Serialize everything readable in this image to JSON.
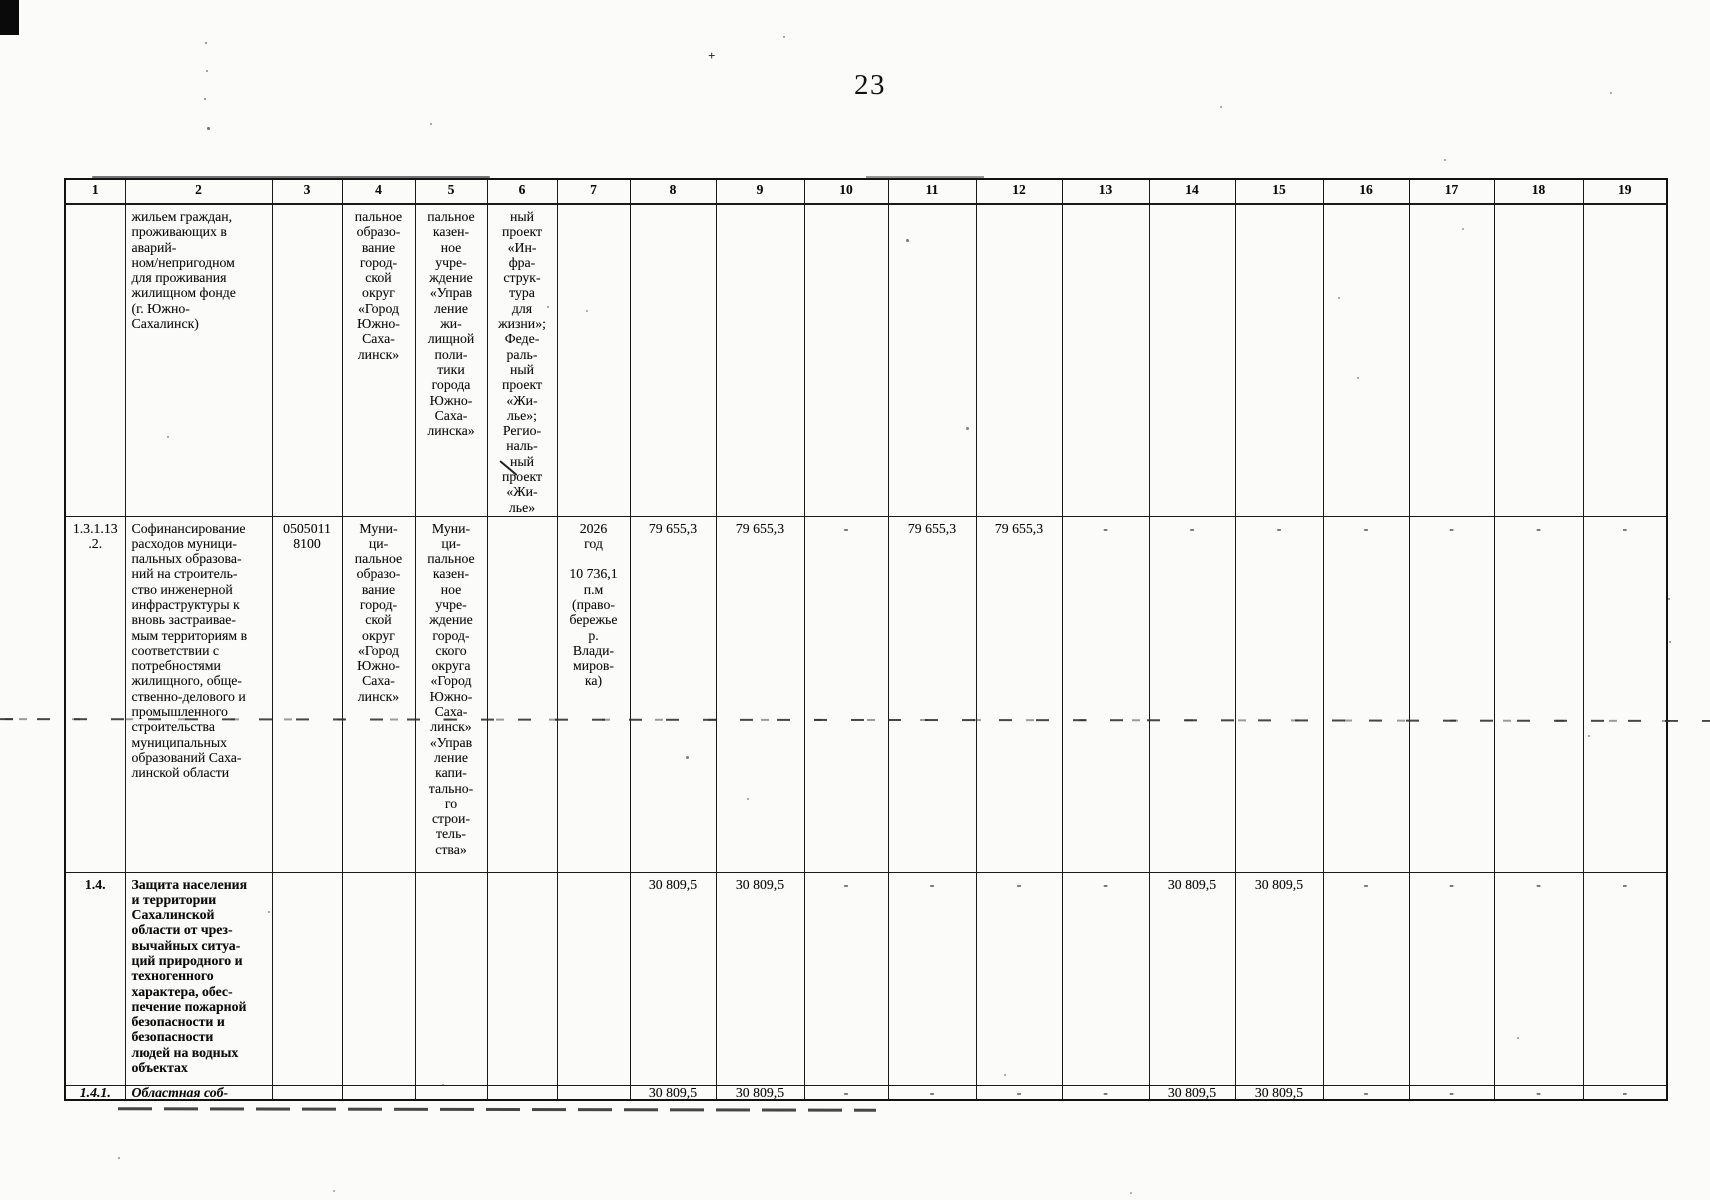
{
  "page": {
    "number": "23"
  },
  "table": {
    "col_headers": [
      "1",
      "2",
      "3",
      "4",
      "5",
      "6",
      "7",
      "8",
      "9",
      "10",
      "11",
      "12",
      "13",
      "14",
      "15",
      "16",
      "17",
      "18",
      "19"
    ],
    "rows": [
      {
        "id": "row-continuation",
        "cells": [
          "",
          "жильем граждан,\nпроживающих в\nаварий-\nном/непригодном\nдля проживания\nжилищном фонде\n(г. Южно-\nСахалинск)",
          "",
          "пальное\nобразо-\nвание\nгород-\nской\nокруг\n«Город\nЮжно-\nСаха-\nлинск»",
          "пальное\nказен-\nное\nучре-\nждение\n«Управ\nление\nжи-\nлищной\nполи-\nтики\nгорода\nЮжно-\nСаха-\nлинска»",
          "ный\nпроект\n«Ин-\nфра-\nструк-\nтура\nдля\nжизни»;\nФеде-\nраль-\nный\nпроект\n«Жи-\nлье»;\nРегио-\nналь-\nный\nпроект\n«Жи-\nлье»",
          "",
          "",
          "",
          "",
          "",
          "",
          "",
          "",
          "",
          "",
          "",
          "",
          ""
        ]
      },
      {
        "id": "row-1-3-1-13-2",
        "cells": [
          "1.3.1.13\n.2.",
          "Софинансирование\nрасходов муници-\nпальных образова-\nний на строитель-\nство инженерной\nинфраструктуры к\nвновь застраивае-\nмым территориям в\nсоответствии с\nпотребностями\nжилищного, обще-\nственно-делового и\nпромышленного\nстроительства\nмуниципальных\nобразований Саха-\nлинской области",
          "0505011\n8100",
          "Муни-\nци-\nпальное\nобразо-\nвание\nгород-\nской\nокруг\n«Город\nЮжно-\nСаха-\nлинск»",
          "Муни-\nци-\nпальное\nказен-\nное\nучре-\nждение\nгород-\nского\nокруга\n«Город\nЮжно-\nСаха-\nлинск»\n«Управ\nление\nкапи-\nтально-\nго\nстрои-\nтель-\nства»",
          "",
          "2026\nгод\n\n10 736,1\nп.м\n(право-\nбережье\nр.\nВлади-\nмиров-\nка)",
          "79 655,3",
          "79 655,3",
          "-",
          "79 655,3",
          "79 655,3",
          "-",
          "-",
          "-",
          "-",
          "-",
          "-",
          "-"
        ]
      },
      {
        "id": "row-1-4",
        "cells": [
          "1.4.",
          "Защита населения\nи территории\nСахалинской\nобласти от чрез-\nвычайных ситуа-\nций природного и\nтехногенного\nхарактера, обес-\nпечение пожарной\nбезопасности и\nбезопасности\nлюдей на водных\nобъектах",
          "",
          "",
          "",
          "",
          "",
          "30 809,5",
          "30 809,5",
          "-",
          "-",
          "-",
          "-",
          "30 809,5",
          "30 809,5",
          "-",
          "-",
          "-",
          "-"
        ]
      },
      {
        "id": "row-1-4-1",
        "cells": [
          "1.4.1.",
          "Областная соб-",
          "",
          "",
          "",
          "",
          "",
          "30 809,5",
          "30 809,5",
          "-",
          "-",
          "-",
          "-",
          "30 809,5",
          "30 809,5",
          "-",
          "-",
          "-",
          "-"
        ]
      }
    ]
  }
}
